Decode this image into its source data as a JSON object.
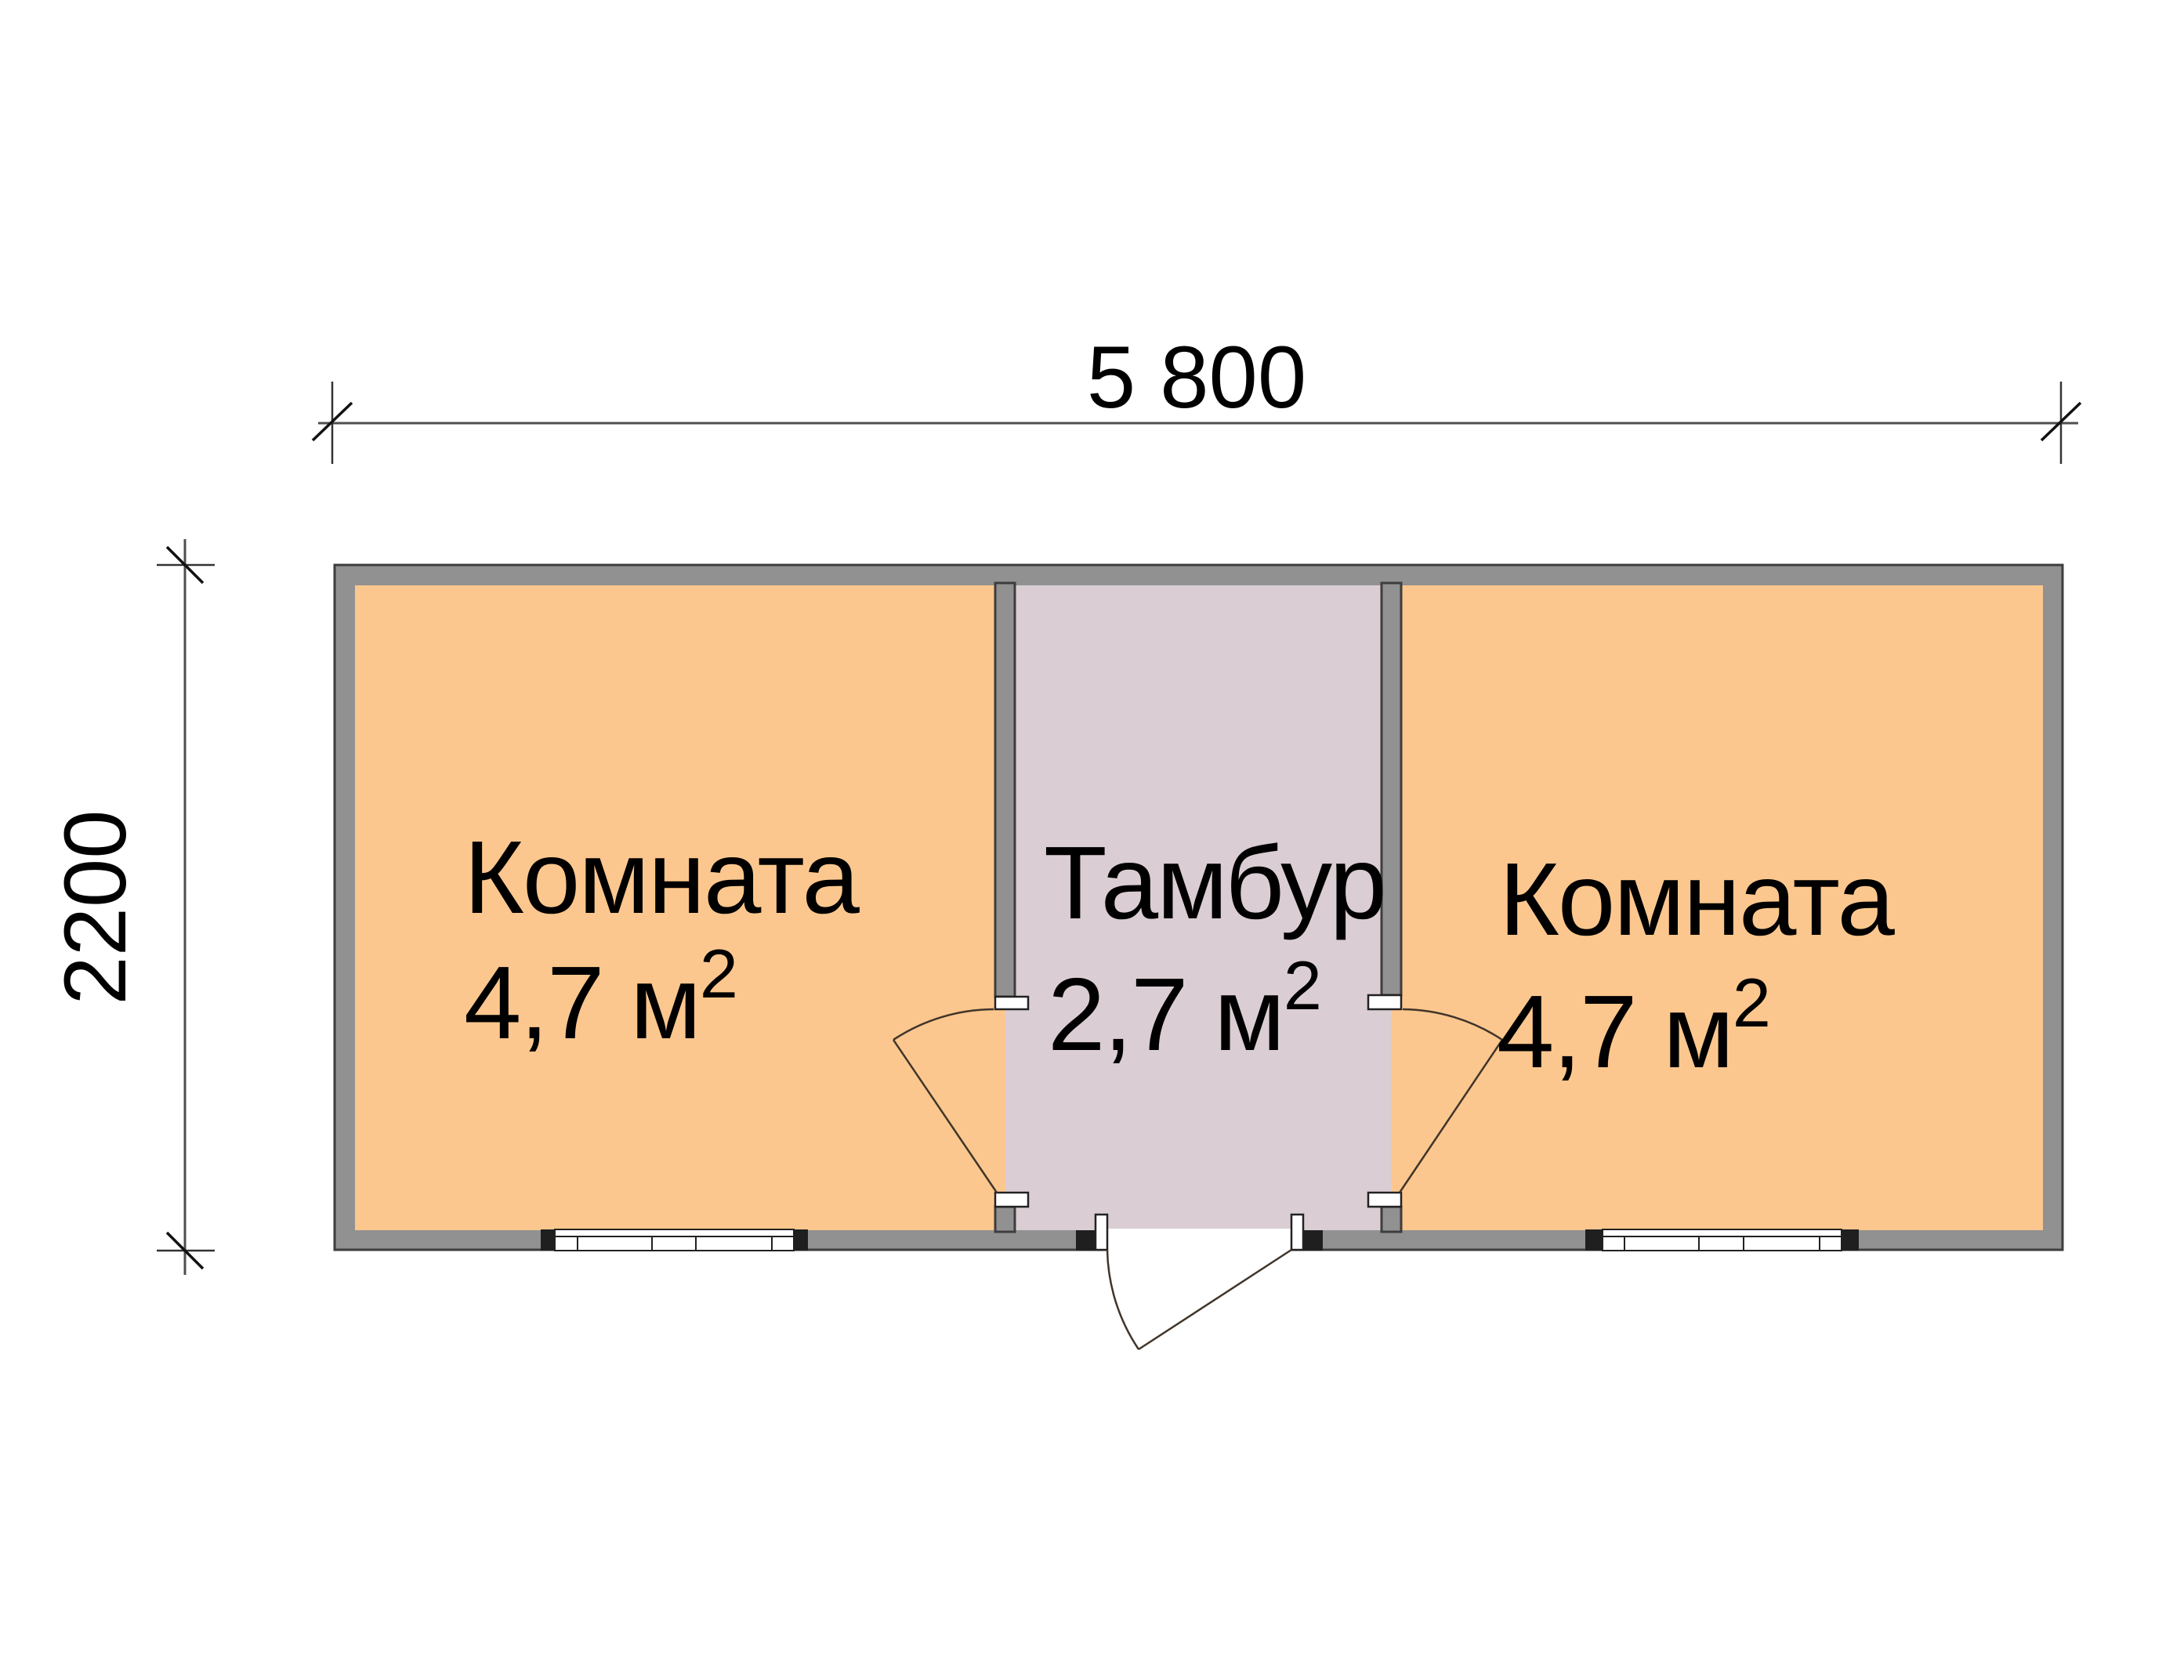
{
  "plan": {
    "dimensions": {
      "width_label": "5 800",
      "height_label": "2200"
    },
    "rooms": [
      {
        "id": "room-left",
        "name": "Комната",
        "area_value": "4,7 м",
        "area_sup": "2"
      },
      {
        "id": "tambour",
        "name": "Тамбур",
        "area_value": "2,7 м",
        "area_sup": "2"
      },
      {
        "id": "room-right",
        "name": "Комната",
        "area_value": "4,7 м",
        "area_sup": "2"
      }
    ],
    "colors": {
      "room_fill": "#fcc78e",
      "tambour_fill": "#dacdd3",
      "wall_fill": "#919191",
      "background": "#ffffff"
    }
  }
}
